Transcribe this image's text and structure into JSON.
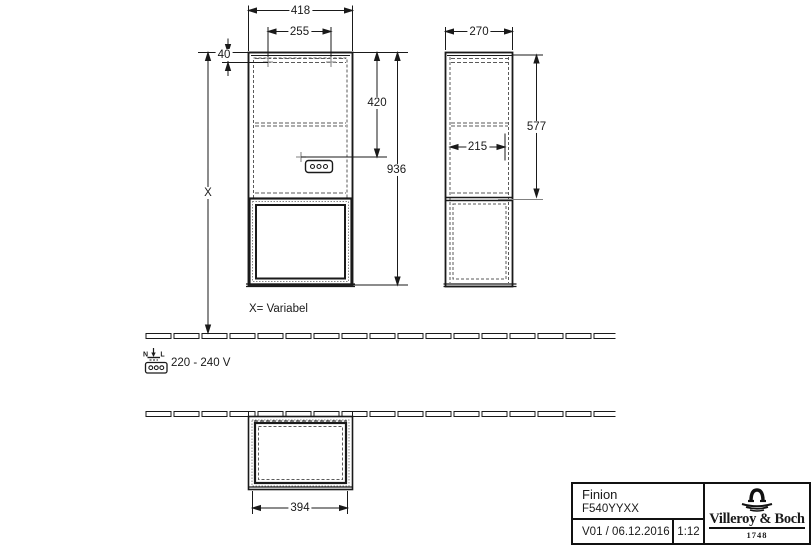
{
  "colors": {
    "line": "#1a1a1a",
    "hidden": "#5a5a5a",
    "marker": "#9a9a9a"
  },
  "views": {
    "front": {
      "label_width": "418",
      "label_hole_spacing": "255",
      "label_hole_offset": "40",
      "label_socket_height": "420",
      "label_total_height": "936",
      "label_variable_height": "X"
    },
    "side": {
      "label_depth": "270",
      "label_upper_height": "577",
      "label_socket_depth": "215"
    },
    "plan": {
      "label_opening_width": "394"
    }
  },
  "annotations": {
    "variable_note": "X= Variabel",
    "voltage": "220 - 240 V",
    "terminal_neutral": "N",
    "terminal_live": "L"
  },
  "title_block": {
    "product_name": "Finion",
    "article_number": "F540YYXX",
    "version_date": "V01 / 06.12.2016",
    "scale": "1:12",
    "brand_name": "Villeroy & Boch",
    "brand_year": "1748"
  }
}
